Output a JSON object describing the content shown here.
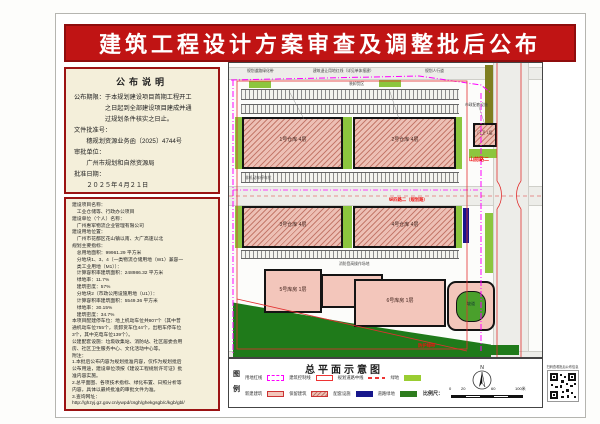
{
  "banner": {
    "title": "建筑工程设计方案审查及调整批后公布"
  },
  "notice": {
    "title": "公布说明",
    "lines": [
      "公布期限：于本规划建设项目首期工程开工",
      "　　　　　之日起到全部建设项目建成并通",
      "　　　　　过规划条件核实之日止。",
      "文件批准号：",
      "　　穗规划资源业务函〔2025〕4744号",
      "审批单位：",
      "　　广州市规划和自然资源局",
      "批准日期：",
      "　　２０２５年４月２１日"
    ]
  },
  "details": {
    "lines": [
      "建设项目名称：",
      "　工业仓储等、行政办公项目",
      "建设单位（个人）名称：",
      "　广州惠军物流企业管理有限公司",
      "建设用地位置：",
      "　广州市花都区花山镇以南、大广高速以北",
      "规划主要指标：",
      "　总用地面积：99961.29 平方米",
      "　分地块1、3、4（一类物流仓储用地（W1）兼容一",
      "　类工业用地（M1））：",
      "　计算容积率建筑面积：248986.32 平方米",
      "　绿地率：11.7%",
      "　建筑密度：57%",
      "　分地块2（市政公用设施用地（U1））：",
      "　计算容积率建筑面积：5549.36 平方米",
      "　绿地率：30.15%",
      "　建筑密度：34.7%",
      "本项目配建停车位：地上机动车位共807个（其中普",
      "通机动车位755个，装卸货车位44个，出租车停车位",
      "3个，其中充电车位139个）。",
      "公建配套设施：垃圾收集站、消防站、社区居委会用",
      "房、社区卫生服务中心、文化活动中心等。",
      "附注：",
      "1.本批后公布内容为规划批准内容，仅作为规划批后",
      "公布用途，建设单位须按《建设工程规划许可证》批",
      "准内容实施。",
      "2.总平面图、各项技术指标、绿化布置、日照分析等",
      "内容，具体以最终批准的审批文件为准。",
      "3.查询网址：",
      "http://ghzyj.gz.gov.cn/ywpd/csgh/ghekgsgb/c/kgb/gbl/"
    ]
  },
  "map": {
    "buildings": {
      "b1": "1号仓库 4层",
      "b2": "2号仓库 4层",
      "b3": "3号仓库 4层",
      "b4": "4号仓库 4层",
      "b5": "门卫 1层",
      "b6": "5号库房 1层",
      "b7": "6号库房 1层",
      "b8": "坡道"
    },
    "road_labels": {
      "r1": "山前路二",
      "r2": "纵四路二（规划路）",
      "r3": "防护绿带"
    },
    "annotations": [
      "规划道路绿化带",
      "建筑退让用地红线（详见单体报建）",
      "装卸货区",
      "规划人行道",
      "市政配套设施",
      "非机动车停车位",
      "消防登高操作场地"
    ]
  },
  "legend": {
    "col_top": "图",
    "col_bottom": "例",
    "title": "总平面示意图",
    "items": [
      {
        "label": "用地红线"
      },
      {
        "label": "建筑控制线"
      },
      {
        "label": "规划道路中线"
      },
      {
        "label": "绿地"
      },
      {
        "label": "新建建筑"
      },
      {
        "label": "保留建筑"
      },
      {
        "label": "配套设施"
      },
      {
        "label": "道路绿地"
      }
    ],
    "scale_label": "比例尺：",
    "scale_ticks": [
      "0",
      "20",
      "60",
      "100米"
    ],
    "north": "N"
  },
  "qr": {
    "caption": "扫码查看批后公布信息"
  },
  "colors": {
    "banner_red": "#c01414",
    "panel_cream": "#f4efda",
    "border_dark_red": "#9b1313",
    "boundary_magenta": "#ff00ff",
    "site_red": "#e13030",
    "green_bright": "#8cc63e",
    "green_dark": "#1f7a1a",
    "navy": "#17178c",
    "building_pink": "#f3c6bb",
    "hatch_pink": "#edc0b5"
  }
}
